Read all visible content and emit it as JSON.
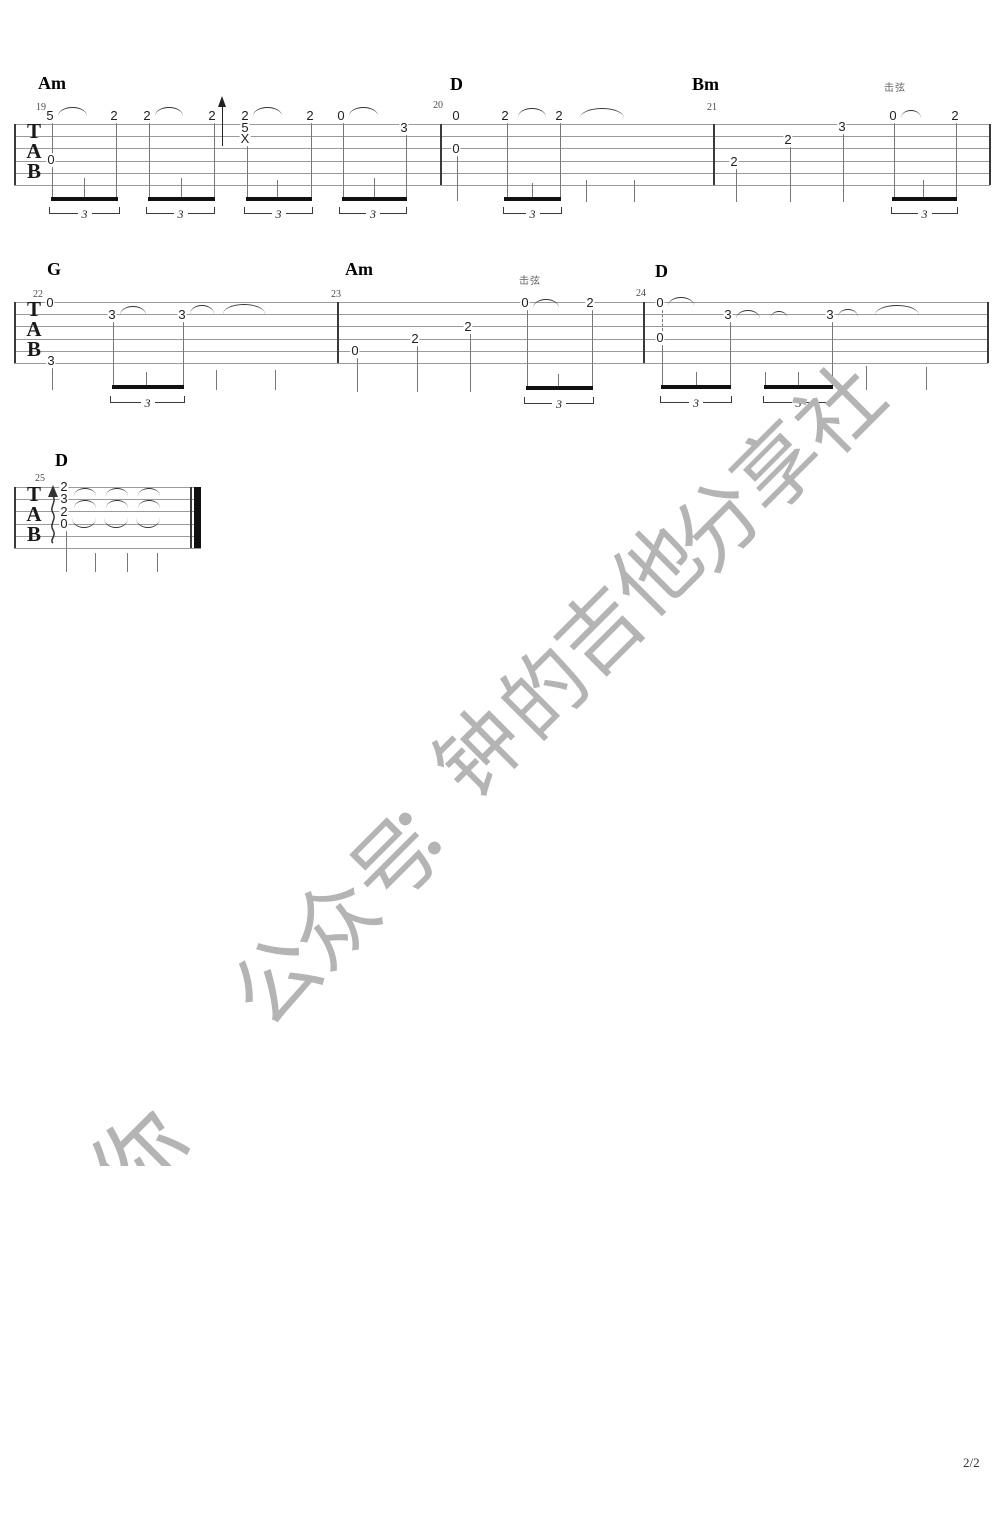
{
  "page": {
    "width": 1000,
    "height": 1528,
    "background": "#ffffff",
    "page_number": "2/2"
  },
  "watermark": {
    "color": "#b4b4b4",
    "angle_deg": -45,
    "font_size": 84,
    "visible_text": "公众号：钟的吉他分享社",
    "chars": [
      [
        "公",
        272,
        976
      ],
      [
        "众",
        330,
        918
      ],
      [
        "号",
        390,
        858
      ],
      [
        "：",
        428,
        812
      ],
      [
        "钟",
        475,
        748
      ],
      [
        "的",
        540,
        688
      ],
      [
        "吉",
        595,
        627
      ],
      [
        "他",
        652,
        566
      ],
      [
        "分",
        713,
        520
      ],
      [
        "享",
        773,
        463
      ],
      [
        "社",
        835,
        405
      ]
    ],
    "fragment": {
      "char": "你",
      "x": 92,
      "y": 1080,
      "w": 105,
      "h": 86
    }
  },
  "score": {
    "colors": {
      "staff_line": "#9a9a9a",
      "barline": "#3a3a3a",
      "note": "#1f1f1f",
      "stem": "#777777",
      "beam": "#111111",
      "arc": "#333333",
      "bracket": "#3a3a3a",
      "chord": "#000000",
      "measure_no": "#4a4a4a",
      "annotation": "#666666",
      "clef": "#1a1a1a"
    },
    "clef_letters": [
      "T",
      "A",
      "B"
    ],
    "tuplet_label": "3",
    "systems": [
      {
        "staff": {
          "x": 14,
          "width": 976,
          "top": 124,
          "line_gap": 12.2,
          "lines": 6
        },
        "chords": [
          [
            "Am",
            38,
            74
          ],
          [
            "D",
            450,
            75
          ],
          [
            "Bm",
            692,
            75
          ]
        ],
        "measure_numbers": [
          [
            "19",
            36,
            103
          ],
          [
            "20",
            433,
            101
          ],
          [
            "21",
            707,
            103
          ]
        ],
        "annotations": [
          [
            "击弦",
            884,
            84
          ]
        ],
        "barlines": [
          14,
          440,
          713,
          989
        ],
        "notes": [
          [
            "5",
            50,
            116
          ],
          [
            "0",
            51,
            160
          ],
          [
            "2",
            114,
            116
          ],
          [
            "2",
            147,
            116
          ],
          [
            "2",
            212,
            116
          ],
          [
            "2",
            245,
            116
          ],
          [
            "5",
            245,
            128
          ],
          [
            "X",
            245,
            139
          ],
          [
            "2",
            310,
            116
          ],
          [
            "0",
            341,
            116
          ],
          [
            "3",
            404,
            128
          ],
          [
            "0",
            456,
            116
          ],
          [
            "0",
            456,
            149
          ],
          [
            "2",
            505,
            116
          ],
          [
            "2",
            559,
            116
          ],
          [
            "2",
            734,
            162
          ],
          [
            "2",
            788,
            140
          ],
          [
            "3",
            842,
            127
          ],
          [
            "0",
            893,
            116
          ],
          [
            "2",
            955,
            116
          ]
        ],
        "arcs": [
          [
            58,
            107,
            29,
            8,
            "o"
          ],
          [
            155,
            107,
            28,
            8,
            "o"
          ],
          [
            253,
            107,
            29,
            8,
            "o"
          ],
          [
            349,
            107,
            29,
            8,
            "o"
          ],
          [
            518,
            108,
            28,
            8,
            "o"
          ],
          [
            580,
            108,
            44,
            9,
            "o"
          ],
          [
            901,
            110,
            20,
            7,
            "o"
          ]
        ],
        "stems": [
          [
            52,
            122,
            197
          ],
          [
            84,
            178,
            197
          ],
          [
            116,
            122,
            197
          ],
          [
            149,
            122,
            197
          ],
          [
            181,
            178,
            197
          ],
          [
            214,
            122,
            197
          ],
          [
            247,
            145,
            197
          ],
          [
            277,
            180,
            197
          ],
          [
            311,
            123,
            197
          ],
          [
            343,
            122,
            197
          ],
          [
            374,
            178,
            197
          ],
          [
            406,
            134,
            197
          ],
          [
            457,
            155,
            201
          ],
          [
            507,
            123,
            197
          ],
          [
            532,
            183,
            197
          ],
          [
            560,
            123,
            197
          ],
          [
            586,
            180,
            202
          ],
          [
            634,
            180,
            202
          ],
          [
            736,
            168,
            202
          ],
          [
            790,
            146,
            202
          ],
          [
            843,
            133,
            202
          ],
          [
            894,
            123,
            197
          ],
          [
            923,
            180,
            197
          ],
          [
            956,
            123,
            197
          ]
        ],
        "dashed_stems": [],
        "beams": [
          [
            51,
            118,
            197
          ],
          [
            148,
            215,
            197
          ],
          [
            246,
            312,
            197
          ],
          [
            342,
            407,
            197
          ],
          [
            504,
            561,
            197
          ],
          [
            892,
            957,
            197
          ]
        ],
        "tuplets": [
          [
            49,
            120,
            207
          ],
          [
            146,
            215,
            207
          ],
          [
            244,
            313,
            207
          ],
          [
            339,
            407,
            207
          ],
          [
            503,
            562,
            207
          ],
          [
            891,
            958,
            207
          ]
        ],
        "up_arrows": [
          [
            222,
            96,
            50
          ]
        ],
        "squiggles": []
      },
      {
        "staff": {
          "x": 14,
          "width": 974,
          "top": 302,
          "line_gap": 12.2,
          "lines": 6
        },
        "chords": [
          [
            "G",
            47,
            260
          ],
          [
            "Am",
            345,
            260
          ],
          [
            "D",
            655,
            262
          ]
        ],
        "measure_numbers": [
          [
            "22",
            33,
            290
          ],
          [
            "23",
            331,
            290
          ],
          [
            "24",
            636,
            289
          ]
        ],
        "annotations": [
          [
            "击弦",
            519,
            277
          ]
        ],
        "barlines": [
          14,
          337,
          643,
          987
        ],
        "notes": [
          [
            "0",
            50,
            303
          ],
          [
            "3",
            51,
            361
          ],
          [
            "3",
            112,
            315
          ],
          [
            "3",
            182,
            315
          ],
          [
            "0",
            355,
            351
          ],
          [
            "2",
            415,
            339
          ],
          [
            "2",
            468,
            327
          ],
          [
            "0",
            525,
            303
          ],
          [
            "2",
            590,
            303
          ],
          [
            "0",
            660,
            303
          ],
          [
            "0",
            660,
            338
          ],
          [
            "3",
            728,
            315
          ],
          [
            "3",
            830,
            315
          ]
        ],
        "arcs": [
          [
            120,
            306,
            26,
            8,
            "o"
          ],
          [
            190,
            305,
            24,
            8,
            "o"
          ],
          [
            223,
            304,
            42,
            9,
            "o"
          ],
          [
            533,
            299,
            26,
            8,
            "o"
          ],
          [
            668,
            297,
            26,
            8,
            "o"
          ],
          [
            736,
            310,
            24,
            8,
            "o"
          ],
          [
            770,
            311,
            18,
            7,
            "o"
          ],
          [
            838,
            309,
            20,
            7,
            "o"
          ],
          [
            875,
            305,
            44,
            9,
            "o"
          ]
        ],
        "stems": [
          [
            52,
            368,
            390
          ],
          [
            113,
            322,
            385
          ],
          [
            146,
            372,
            385
          ],
          [
            183,
            322,
            385
          ],
          [
            216,
            370,
            390
          ],
          [
            275,
            370,
            390
          ],
          [
            357,
            358,
            392
          ],
          [
            417,
            346,
            392
          ],
          [
            470,
            334,
            392
          ],
          [
            527,
            310,
            386
          ],
          [
            558,
            374,
            386
          ],
          [
            592,
            310,
            386
          ],
          [
            662,
            344,
            385
          ],
          [
            696,
            372,
            385
          ],
          [
            730,
            322,
            385
          ],
          [
            765,
            372,
            385
          ],
          [
            798,
            372,
            385
          ],
          [
            832,
            322,
            385
          ],
          [
            866,
            366,
            390
          ],
          [
            926,
            367,
            390
          ]
        ],
        "dashed_stems": [
          [
            662,
            310,
            331
          ]
        ],
        "beams": [
          [
            112,
            184,
            385
          ],
          [
            526,
            593,
            386
          ],
          [
            661,
            731,
            385
          ],
          [
            764,
            833,
            385
          ]
        ],
        "tuplets": [
          [
            110,
            185,
            396
          ],
          [
            524,
            594,
            397
          ],
          [
            660,
            732,
            396
          ],
          [
            763,
            834,
            396
          ]
        ],
        "up_arrows": [],
        "squiggles": []
      },
      {
        "staff": {
          "x": 14,
          "width": 187,
          "top": 487,
          "line_gap": 12.2,
          "lines": 6
        },
        "chords": [
          [
            "D",
            55,
            451
          ]
        ],
        "measure_numbers": [
          [
            "25",
            35,
            474
          ]
        ],
        "annotations": [],
        "barlines": [
          14
        ],
        "end_bar": {
          "thin_x": 190,
          "thick_x": 194,
          "thick_w": 7
        },
        "notes": [
          [
            "2",
            64,
            487
          ],
          [
            "3",
            64,
            499
          ],
          [
            "2",
            64,
            512
          ],
          [
            "0",
            64,
            524
          ]
        ],
        "arcs": [
          [
            74,
            488,
            22,
            7,
            "o"
          ],
          [
            106,
            488,
            22,
            7,
            "o"
          ],
          [
            138,
            488,
            22,
            7,
            "o"
          ],
          [
            74,
            500,
            22,
            7,
            "o"
          ],
          [
            106,
            500,
            22,
            7,
            "o"
          ],
          [
            138,
            500,
            22,
            7,
            "o"
          ],
          [
            72,
            518,
            24,
            9,
            "u"
          ],
          [
            104,
            518,
            24,
            9,
            "u"
          ],
          [
            136,
            518,
            24,
            9,
            "u"
          ]
        ],
        "stems": [
          [
            66,
            531,
            572
          ],
          [
            95,
            553,
            572
          ],
          [
            127,
            553,
            572
          ],
          [
            157,
            553,
            572
          ]
        ],
        "dashed_stems": [],
        "beams": [],
        "tuplets": [],
        "up_arrows": [],
        "squiggles": [
          [
            46,
            485,
            60
          ]
        ]
      }
    ]
  }
}
